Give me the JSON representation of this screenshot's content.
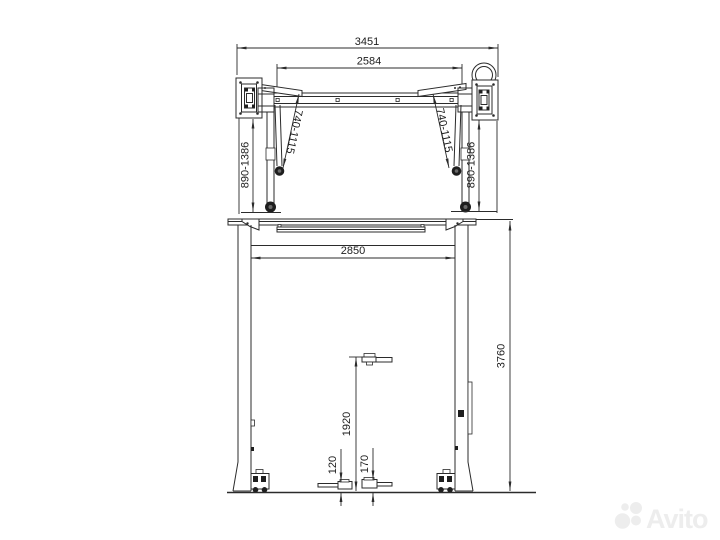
{
  "drawing": {
    "subject": "two-post car lift technical drawing, top view and front view",
    "line_color": "#2b2b2b",
    "background": "#ffffff"
  },
  "top_view": {
    "dims": {
      "overall_width": "3451",
      "beam_width": "2584",
      "arm_reach_left": "740-1115",
      "arm_reach_right": "740-1115",
      "arm_span_left": "890-1386",
      "arm_span_right": "890-1386"
    }
  },
  "front_view": {
    "dims": {
      "inner_width": "2850",
      "overall_height": "3760",
      "lift_height": "1920",
      "pad_min_height_left": "120",
      "pad_min_height_right": "170"
    }
  },
  "watermark": {
    "text": "Avito",
    "color": "#ededed"
  }
}
